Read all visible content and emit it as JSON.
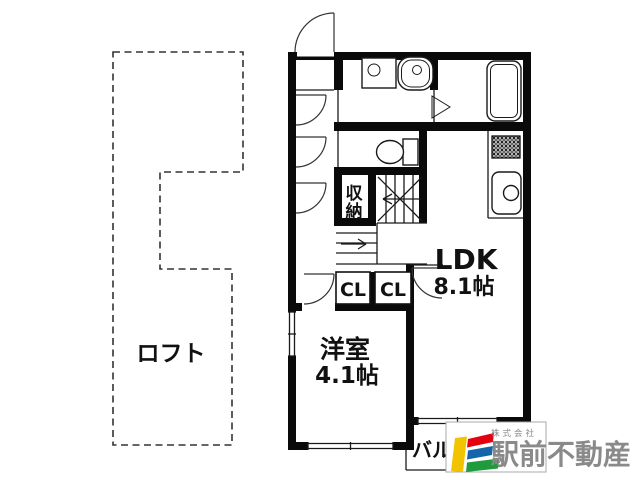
{
  "labels": {
    "loft": "ロフト",
    "storage_char1": "収",
    "storage_char2": "納",
    "closet_left": "CL",
    "closet_right": "CL",
    "ldk_name": "LDK",
    "ldk_size": "8.1帖",
    "western_room_name": "洋室",
    "western_room_size": "4.1帖",
    "balcony": "バルコニー"
  },
  "brand": {
    "prefix": "株式会社",
    "name": "駅前不動産",
    "colors": {
      "yellow": "#f2c400",
      "red": "#e3000f",
      "blue": "#1565ab",
      "green": "#1f9a3d",
      "gray": "#8a8a8a",
      "box_border": "#aaaaaa"
    }
  }
}
